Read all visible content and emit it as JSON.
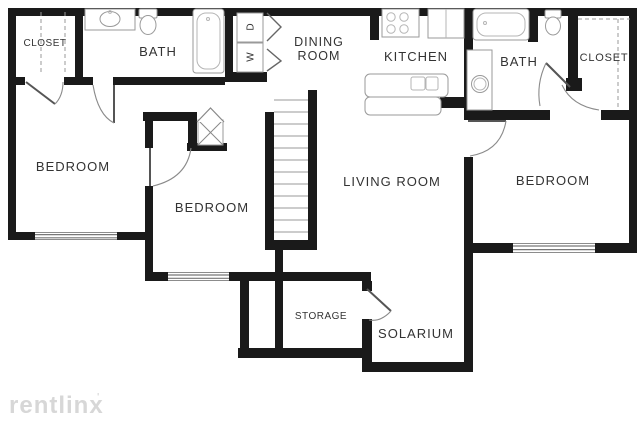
{
  "watermark": {
    "brand": "rentlinx",
    "mark": "'"
  },
  "rooms": {
    "closet_left": "CLOSET",
    "bath_left": "BATH",
    "dining_line1": "DINING",
    "dining_line2": "ROOM",
    "kitchen": "KITCHEN",
    "bath_right": "BATH",
    "closet_right": "CLOSET",
    "bedroom_left": "BEDROOM",
    "bedroom_middle": "BEDROOM",
    "bedroom_right": "BEDROOM",
    "living_room": "LIVING ROOM",
    "storage": "STORAGE",
    "solarium": "SOLARIUM"
  },
  "appliances": {
    "dryer": "D",
    "washer": "W"
  },
  "colors": {
    "wall": "#1a1a1a",
    "label": "#333333",
    "fixture_stroke": "#9a9a9a",
    "watermark": "#d7d7d7",
    "background": "#ffffff"
  }
}
